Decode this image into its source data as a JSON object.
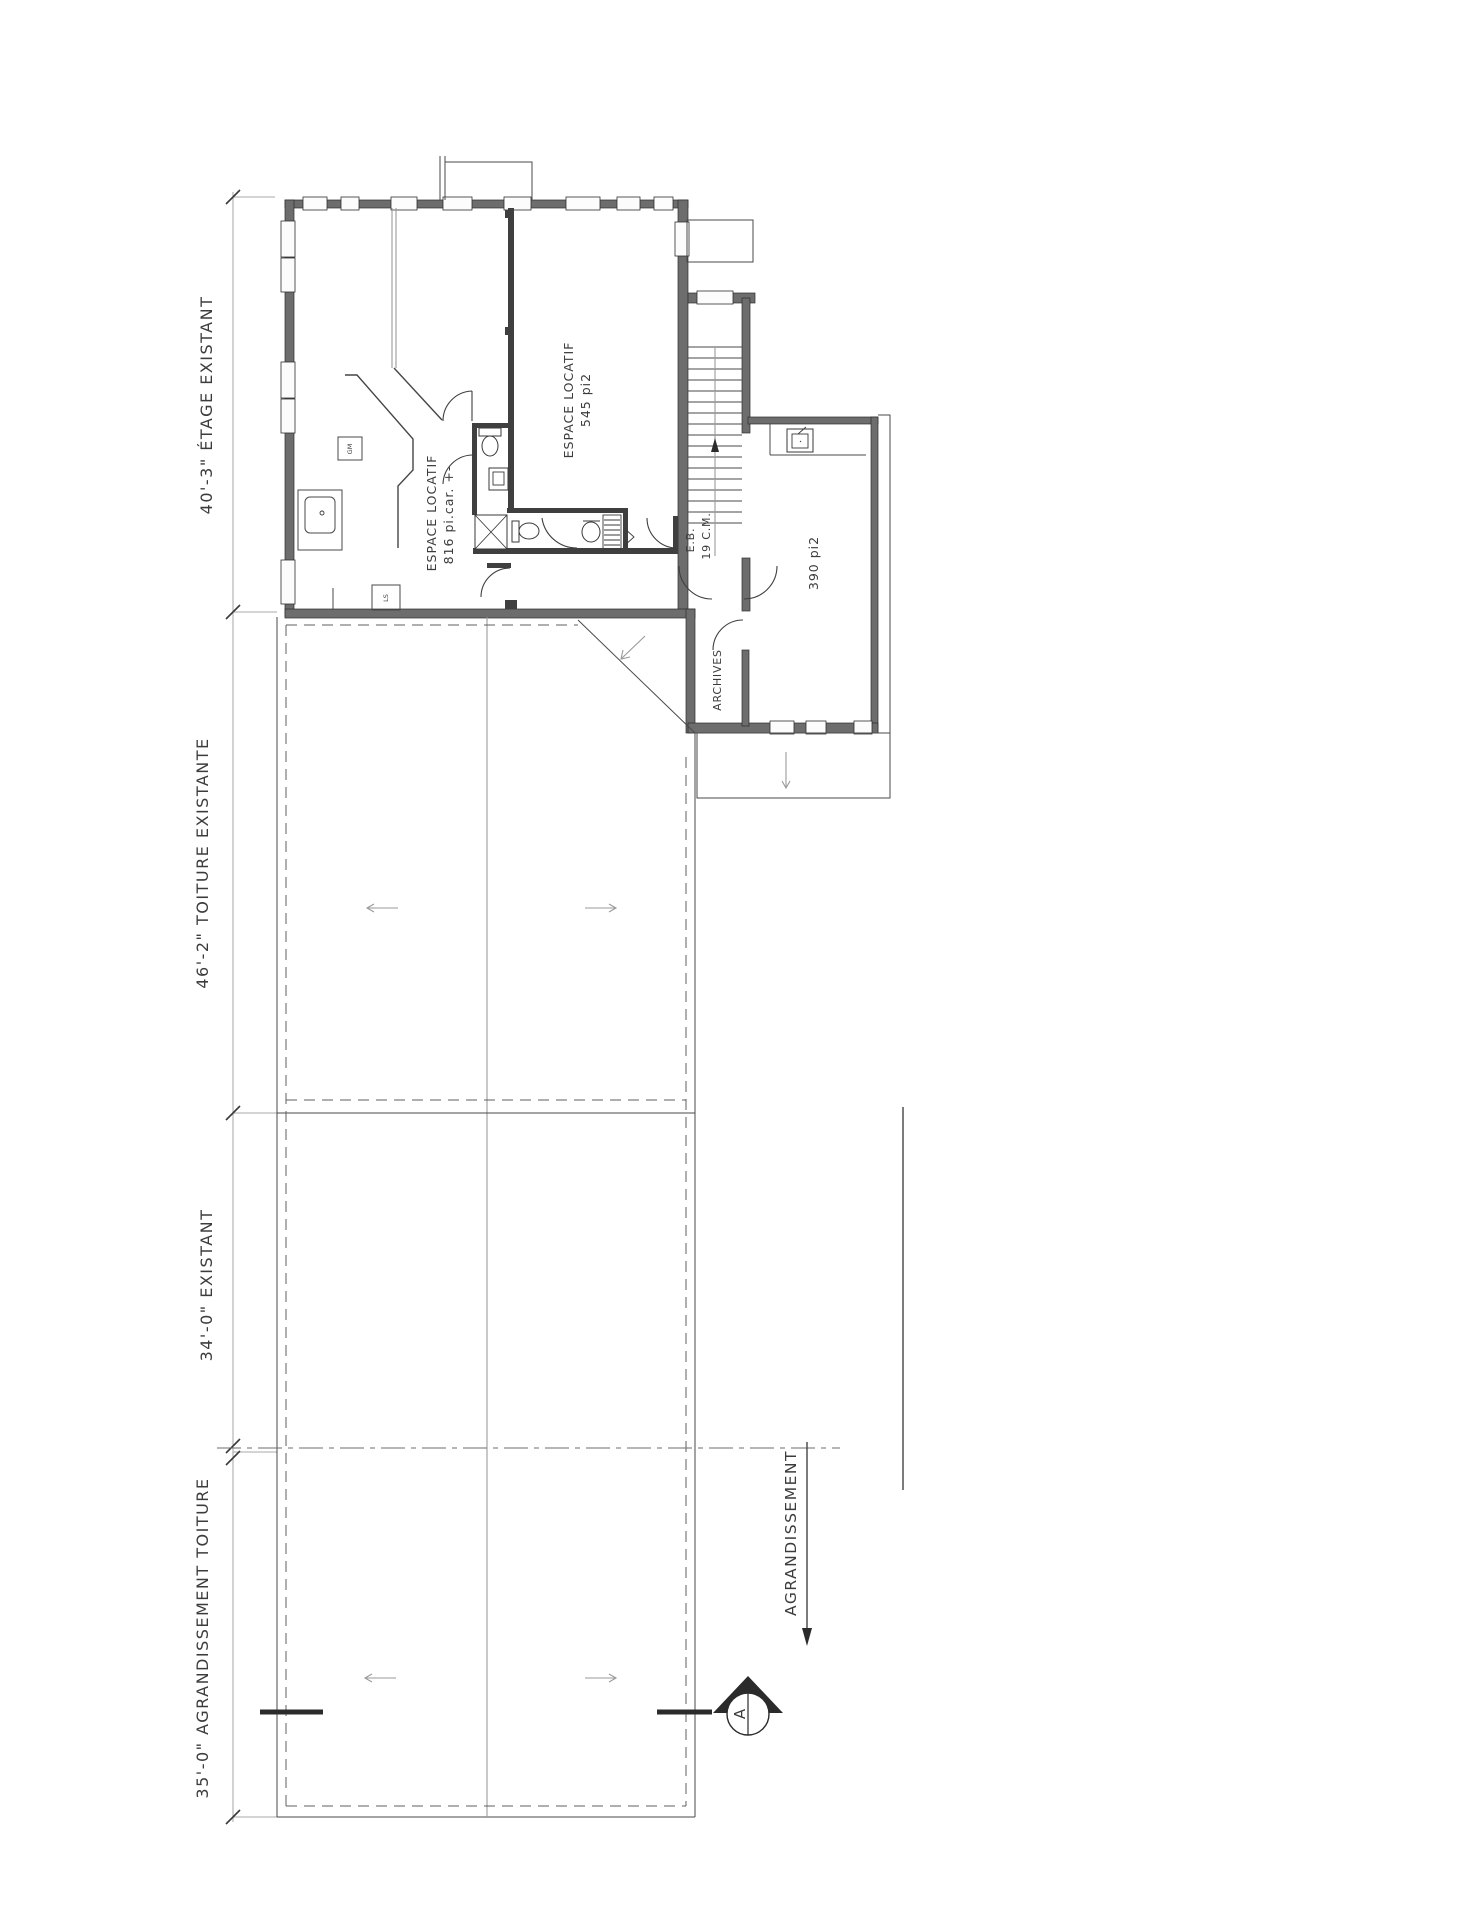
{
  "plan": {
    "dimensions": {
      "etage": "40'-3\" ÉTAGE EXISTANT",
      "toiture": "46'-2\" TOITURE EXISTANTE",
      "existant": "34'-0\" EXISTANT",
      "agrandissement": "35'-0\" AGRANDISSEMENT TOITURE"
    },
    "rooms": {
      "locatif_a_name": "ESPACE LOCATIF",
      "locatif_a_area": "816 pi.car. +-",
      "locatif_b_name": "ESPACE LOCATIF",
      "locatif_b_area": "545 pi2",
      "room_390": "390 pi2",
      "archives": "ARCHIVES"
    },
    "stair": {
      "eb": "E.B.",
      "cm": "19 C.M."
    },
    "appliances": {
      "gm": "GM",
      "ls": "LS"
    },
    "callout": {
      "agrandissement": "AGRANDISSEMENT"
    },
    "section": {
      "letter": "A"
    },
    "colors": {
      "line": "#3f3f3f",
      "wall_fill": "#6d6d6d",
      "background": "#ffffff"
    }
  }
}
